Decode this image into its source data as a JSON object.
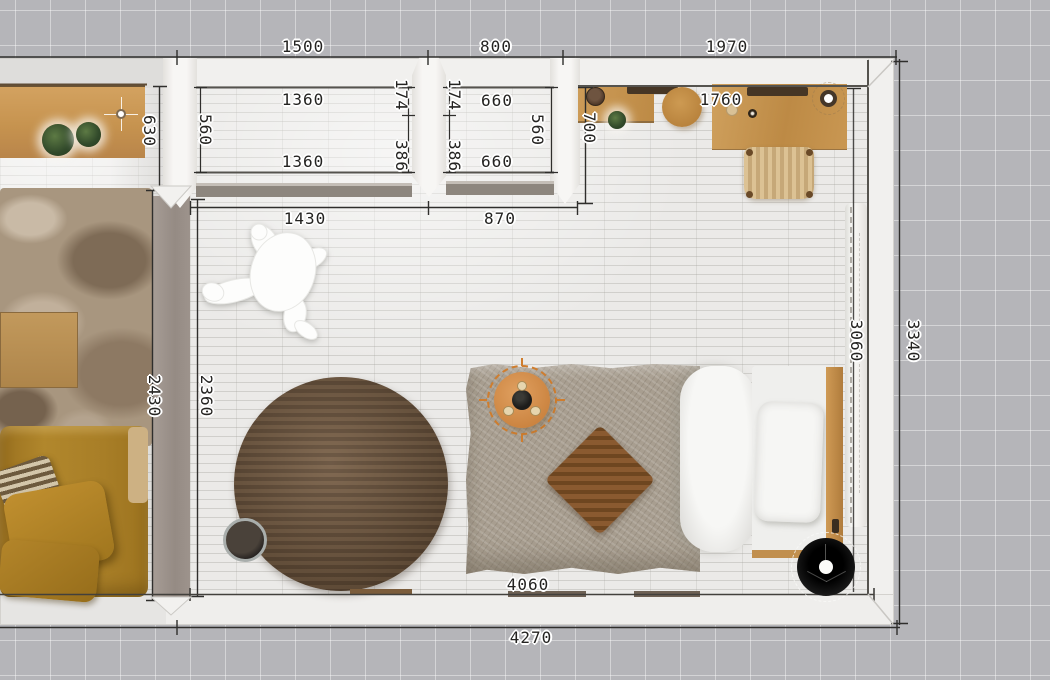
{
  "view": {
    "type": "floor-plan-top-view"
  },
  "dims": {
    "top_left": "1500",
    "top_mid": "800",
    "top_right": "1970",
    "closet1_width_top": "1360",
    "closet1_width_bottom": "1360",
    "closet1_depth": "560",
    "closet2_width_top": "660",
    "closet2_width_bottom": "660",
    "closet2_depth": "560",
    "pier1_upper": "174",
    "pier1_lower": "386",
    "pier2_upper": "174",
    "pier2_lower": "386",
    "sideboard_depth": "630",
    "desk_zone_depth": "700",
    "desk_width": "1760",
    "opening_left": "1430",
    "opening_right": "870",
    "partition_outer": "2430",
    "partition_inner": "2360",
    "room_height_inner": "3060",
    "room_height_outer": "3340",
    "room_width_inner": "4060",
    "room_width_outer": "4270"
  },
  "colors": {
    "grid_background": "#b5b5b9",
    "wall": "#f1f0ee",
    "partition": "#9c928b",
    "wood": "#c69350",
    "sofa": "#a87e27",
    "selection_accent": "#cf7d2e",
    "lamp_black": "#161615"
  },
  "furniture": [
    "sideboard",
    "potted-plant",
    "shag-rug",
    "coffee-table",
    "sofa",
    "round-rug",
    "planter",
    "person-figure",
    "bed",
    "diamond-cushion",
    "bedside-tray-table",
    "floor-lamp",
    "console-shelf",
    "wood-stool",
    "desk",
    "rattan-chair",
    "closet-sliding-door",
    "curtain"
  ]
}
